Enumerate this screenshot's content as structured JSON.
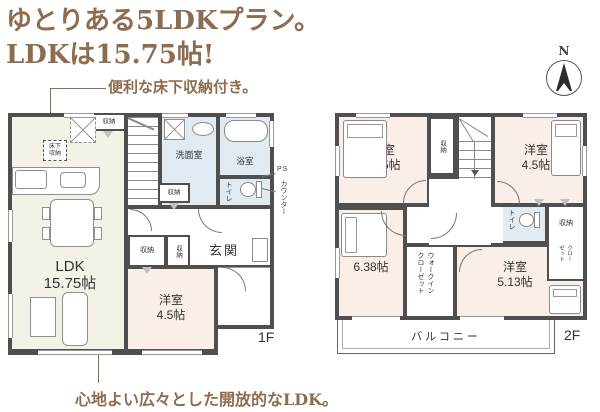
{
  "header": {
    "title_line1": "ゆとりある5LDKプラン。",
    "title_line2": "LDKは15.75帖!",
    "annotation_top": "便利な床下収納付き。",
    "annotation_bottom": "心地よい広々とした開放的なLDK。"
  },
  "colors": {
    "accent_brown": "#8d6c50",
    "wall": "#4f4f4f",
    "ldk_bg": "#f4f1e7",
    "wet_bg": "#e0eaf0",
    "bedroom_bg": "#f9efe8"
  },
  "compass": {
    "north": "N"
  },
  "floor1": {
    "label": "1F",
    "ldk": {
      "name": "LDK",
      "size": "15.75帖"
    },
    "bedroom": {
      "name": "洋室",
      "size": "4.5帖"
    },
    "washroom": "洗面室",
    "bathroom": "浴室",
    "toilet": "トイレ",
    "entrance": "玄関",
    "storage": "収納",
    "underfloor_storage": "床下\n収納",
    "ps": "PS",
    "counter": "カウンター"
  },
  "floor2": {
    "label": "2F",
    "bedroom_525": {
      "name": "洋室",
      "size": "5.25帖"
    },
    "bedroom_45": {
      "name": "洋室",
      "size": "4.5帖"
    },
    "bedroom_638": {
      "name": "洋室",
      "size": "6.38帖"
    },
    "bedroom_513": {
      "name": "洋室",
      "size": "5.13帖"
    },
    "storage": "収納",
    "toilet": "トイレ",
    "walk_in_closet": "ウォークイン\nクローゼット",
    "closet": "クロー\nゼット",
    "balcony": "バルコニー"
  }
}
